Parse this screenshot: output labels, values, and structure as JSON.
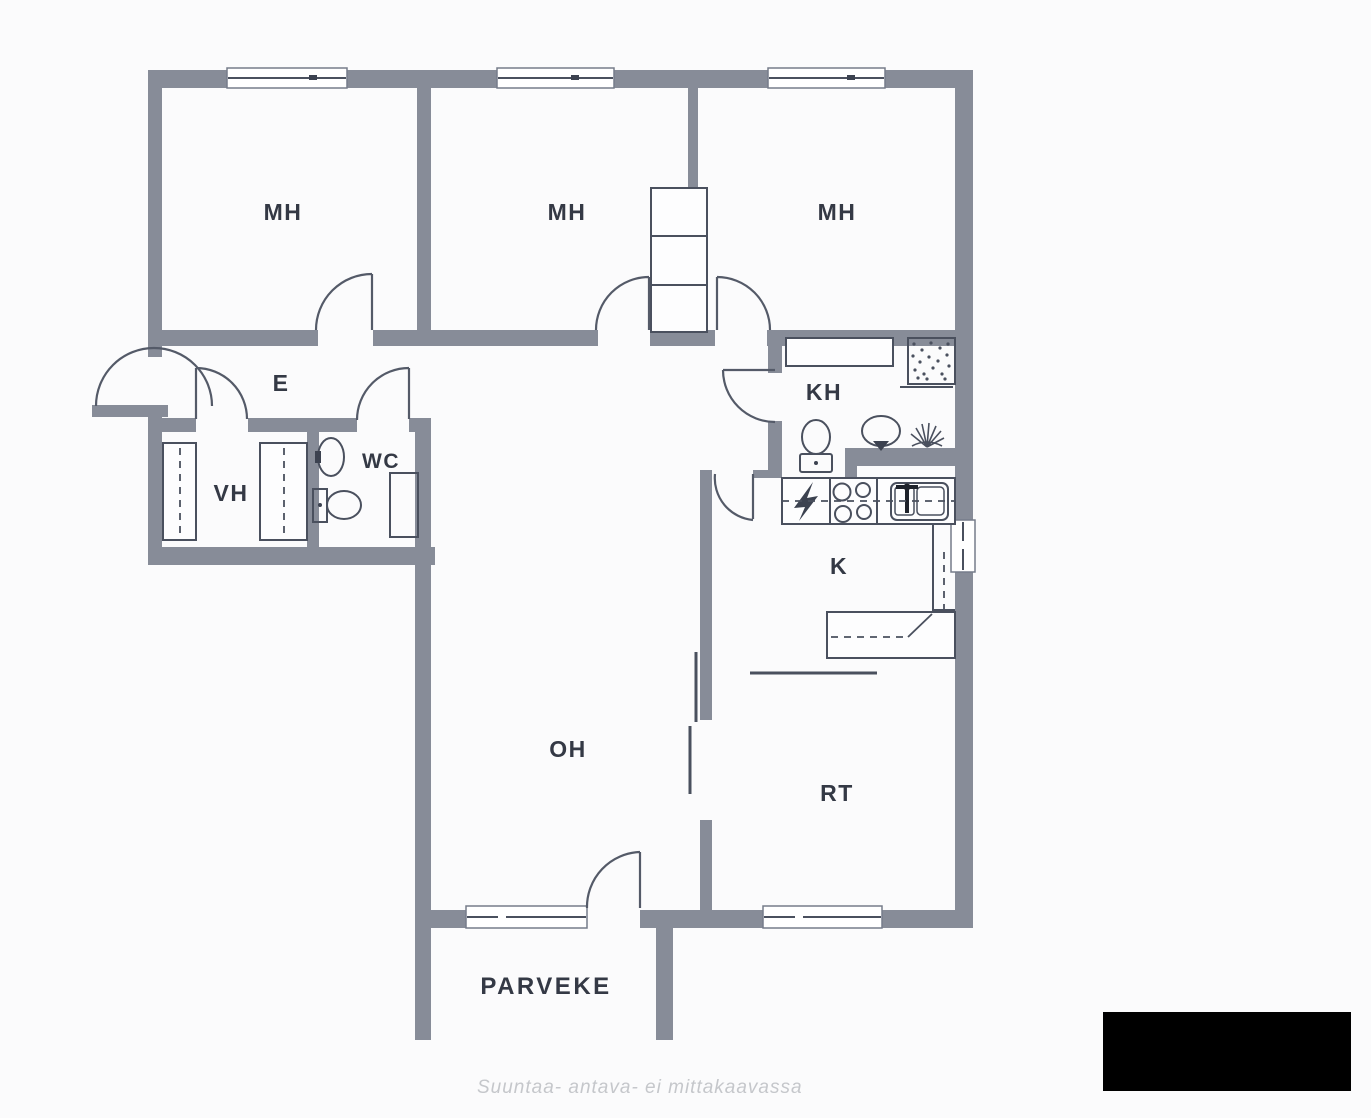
{
  "plan_labels": {
    "bedroom_1": "MH",
    "bedroom_2": "MH",
    "bedroom_3": "MH",
    "entry_hall": "E",
    "walk_in_closet": "VH",
    "wc": "WC",
    "bathroom": "KH",
    "kitchen": "K",
    "living_room": "OH",
    "dining_area": "RT",
    "balcony": "PARVEKE"
  },
  "caption": "Suuntaa- antava- ei mittakaavassa",
  "icons": {
    "entrance_door": "door-swing-icon",
    "interior_doors": "door-swing-icon",
    "toilet": "toilet-icon",
    "washbasin": "sink-icon",
    "shower": "shower-icon",
    "floor_drain": "drain-icon",
    "stove": "stove-icon",
    "kitchen_sink": "kitchen-sink-icon",
    "electrical_panel": "lightning-icon",
    "wardrobes": "wardrobe-icon",
    "sliding_door": "sliding-door-icon",
    "windows": "window-icon"
  },
  "colors": {
    "wall": "#878c98",
    "fixture_line": "#4a505e",
    "label_text": "#343945",
    "caption_text": "#c5c7cb",
    "redaction": "#000000",
    "background": "#fbfbfc"
  }
}
